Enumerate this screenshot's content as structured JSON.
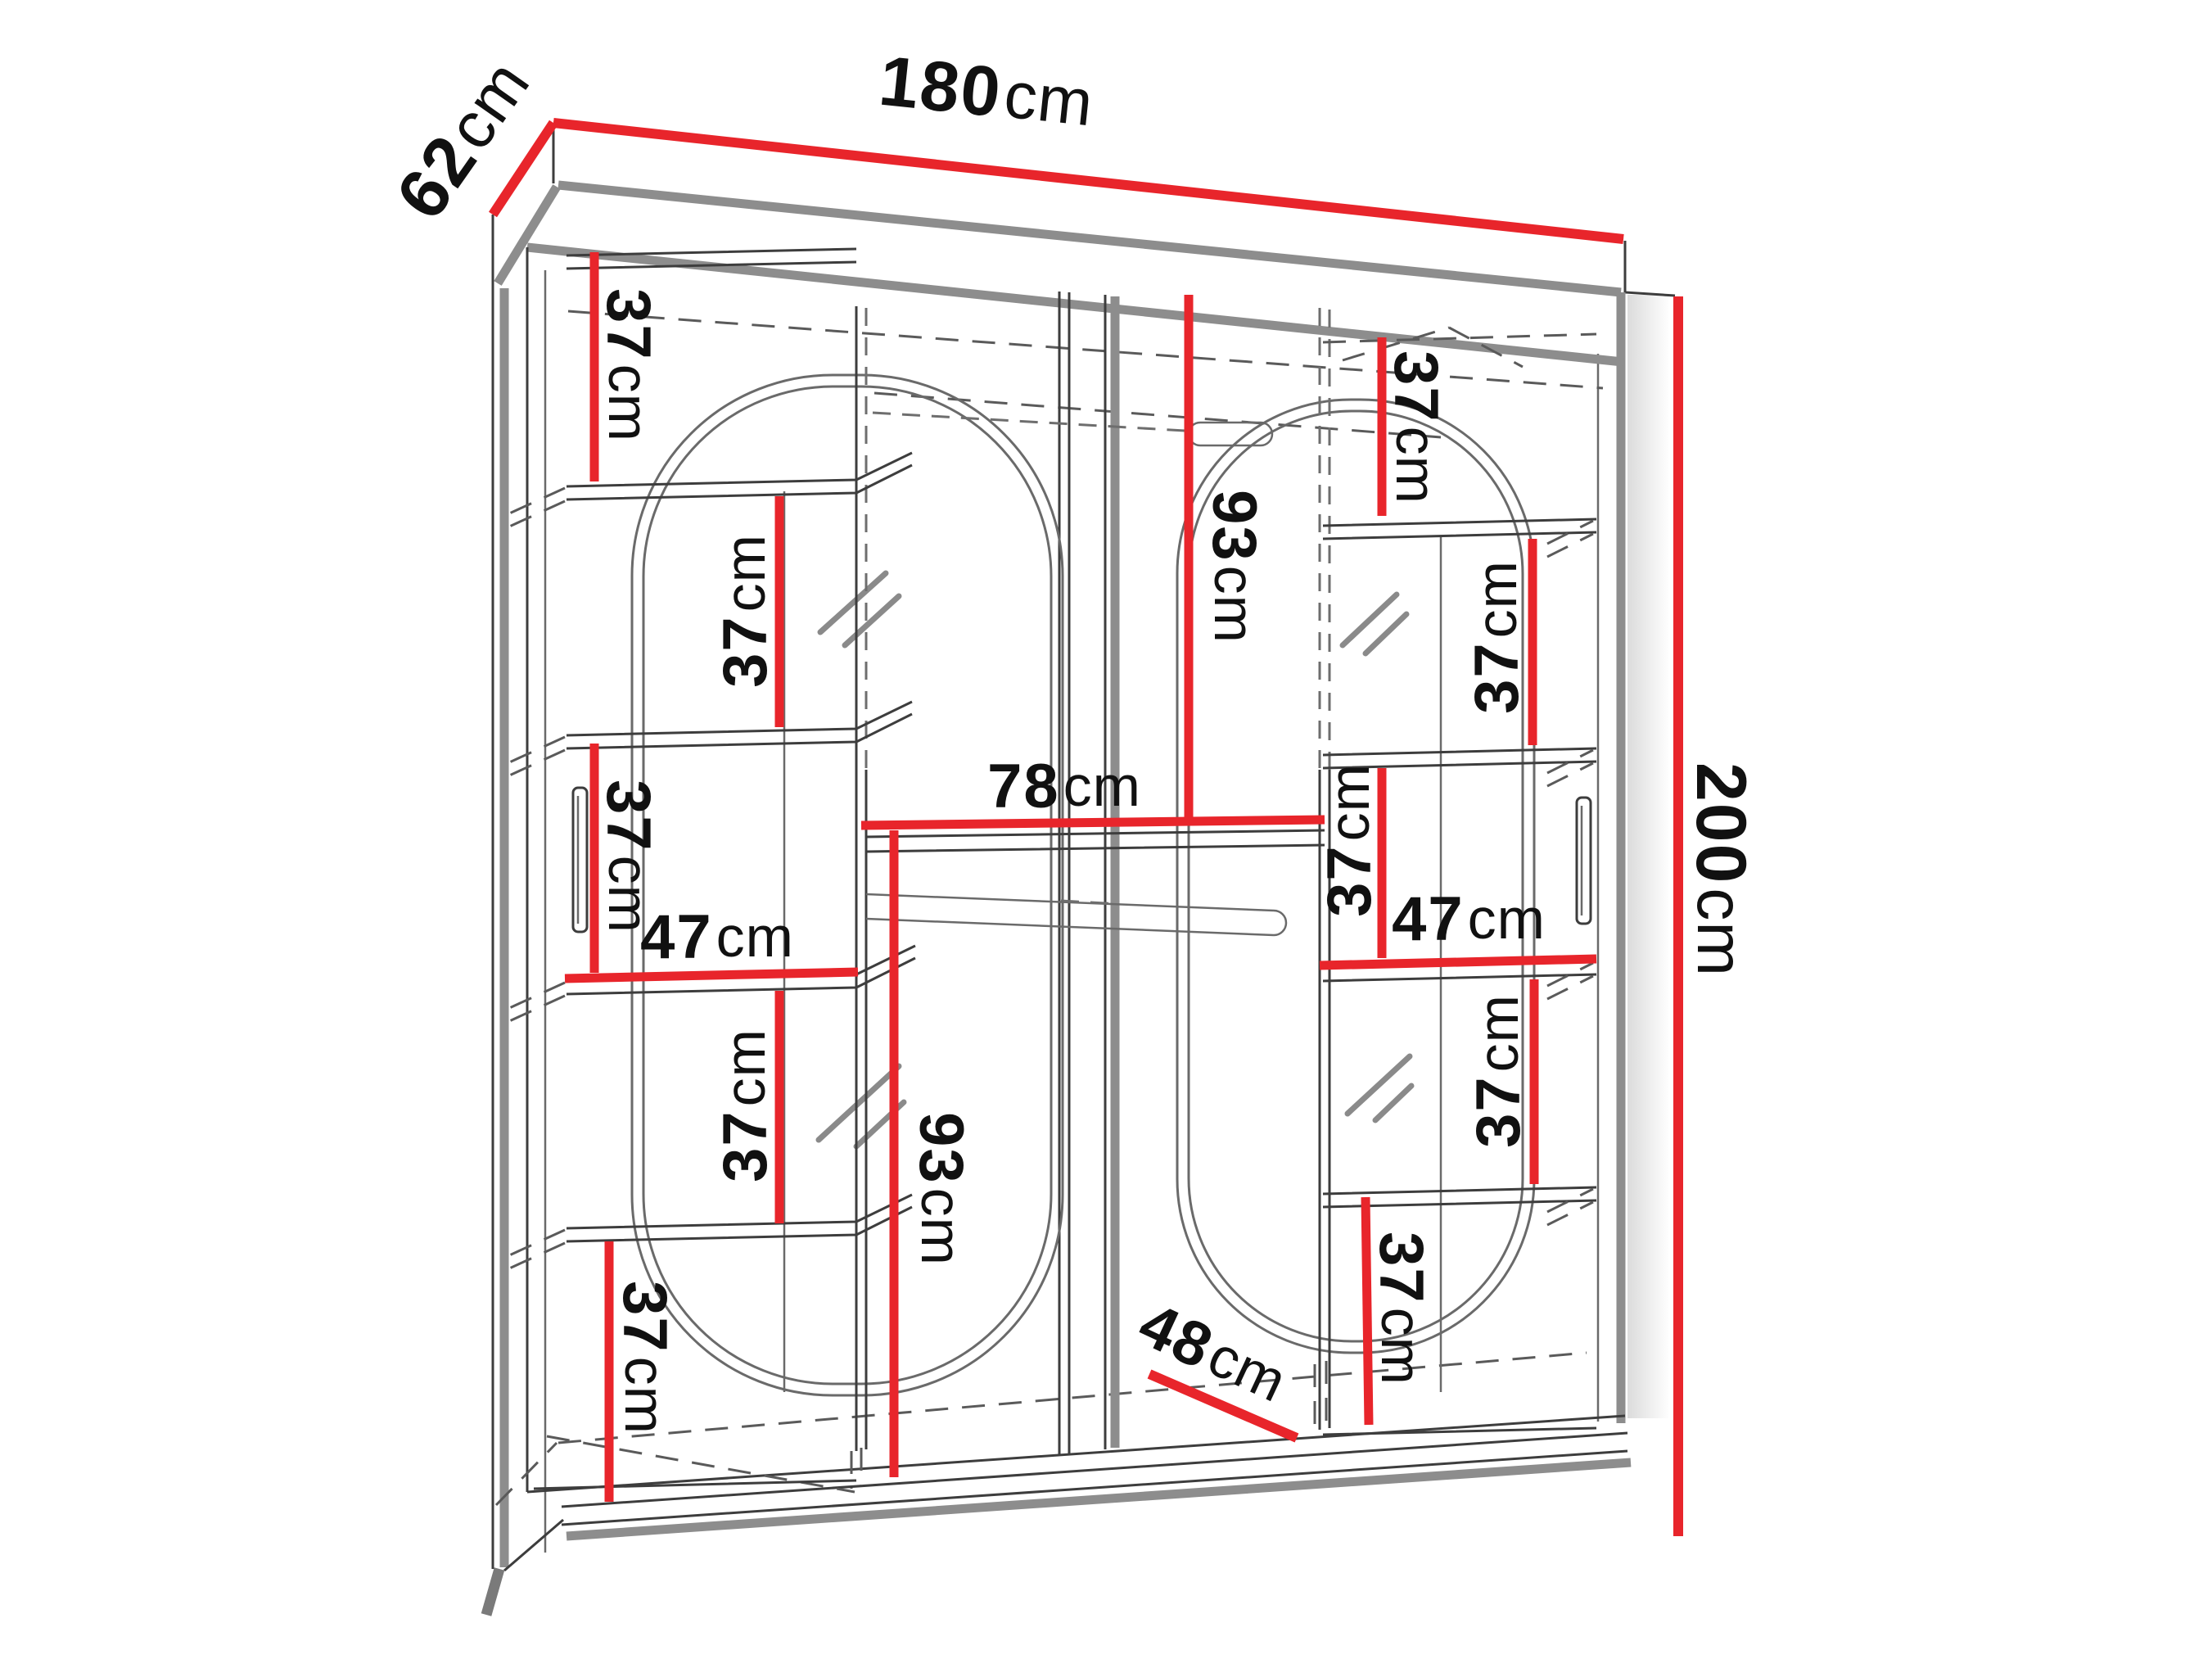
{
  "diagram_type": "wardrobe dimension drawing",
  "unit": "cm",
  "colors": {
    "dimension-red": "#e8252b",
    "line-dark": "#3d3d3d",
    "line-thick": "#8d8d8d",
    "background": "#ffffff",
    "label-ink": "#111111"
  },
  "dimensions": {
    "overall_width": "180",
    "overall_depth": "62",
    "overall_height": "200",
    "center_shelf_width": "78",
    "hanging_section_height": "93",
    "side_shelf_width": "47",
    "shelf_gap": "37",
    "bottom_depth_clearance": "48"
  },
  "labels": [
    {
      "id": "width-top",
      "value": "180",
      "unit": "cm"
    },
    {
      "id": "depth-top-left",
      "value": "62",
      "unit": "cm"
    },
    {
      "id": "height-right",
      "value": "200",
      "unit": "cm"
    },
    {
      "id": "left-gap-top",
      "value": "37",
      "unit": "cm"
    },
    {
      "id": "left-gap-upper",
      "value": "37",
      "unit": "cm"
    },
    {
      "id": "left-gap-middle",
      "value": "37",
      "unit": "cm"
    },
    {
      "id": "left-shelf-width",
      "value": "47",
      "unit": "cm"
    },
    {
      "id": "left-gap-lower",
      "value": "37",
      "unit": "cm"
    },
    {
      "id": "left-gap-bottom",
      "value": "37",
      "unit": "cm"
    },
    {
      "id": "center-shelf-width",
      "value": "78",
      "unit": "cm"
    },
    {
      "id": "center-upper-height",
      "value": "93",
      "unit": "cm"
    },
    {
      "id": "center-lower-height",
      "value": "93",
      "unit": "cm"
    },
    {
      "id": "right-gap-top",
      "value": "37",
      "unit": "cm"
    },
    {
      "id": "right-gap-upper",
      "value": "37",
      "unit": "cm"
    },
    {
      "id": "right-gap-middle",
      "value": "37",
      "unit": "cm"
    },
    {
      "id": "right-shelf-width",
      "value": "47",
      "unit": "cm"
    },
    {
      "id": "right-gap-lower",
      "value": "37",
      "unit": "cm"
    },
    {
      "id": "right-gap-bottom",
      "value": "37",
      "unit": "cm"
    },
    {
      "id": "bottom-depth",
      "value": "48",
      "unit": "cm"
    }
  ]
}
